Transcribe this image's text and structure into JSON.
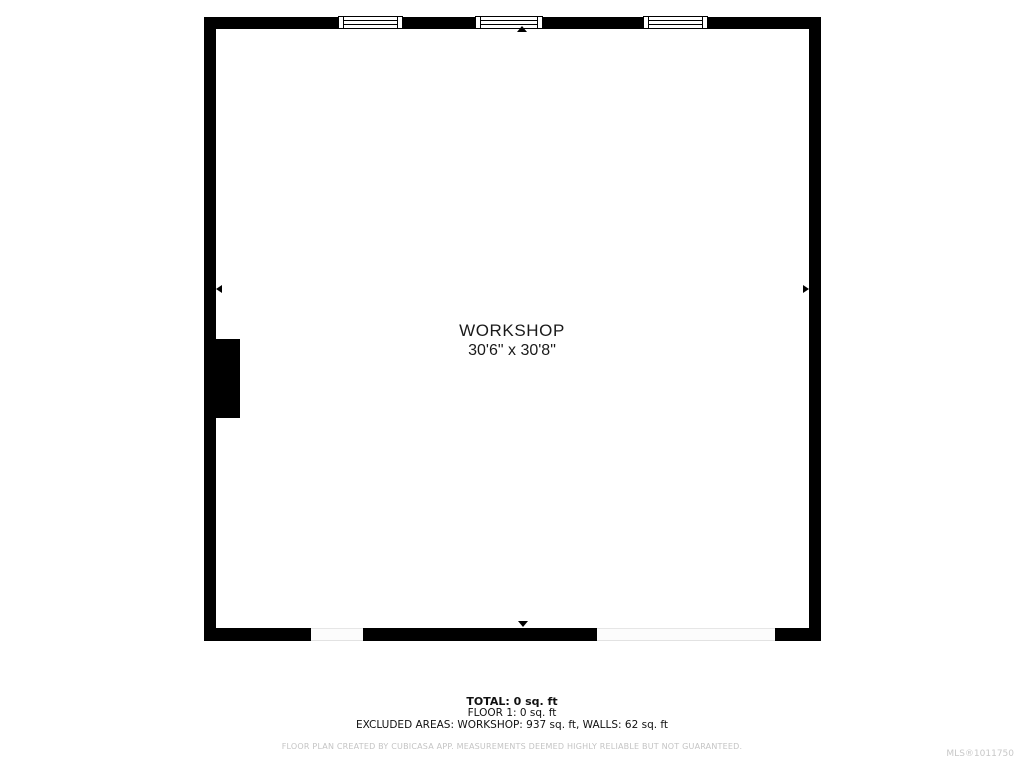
{
  "colors": {
    "wall": "#000000",
    "background": "#ffffff",
    "label_text": "#1a1a1a",
    "muted_text": "#c4c4c4"
  },
  "plan": {
    "room_label": "WORKSHOP",
    "room_dimensions": "30'6\" x 30'8\"",
    "windows_count": 3,
    "door_openings_count": 2
  },
  "summary": {
    "total": "TOTAL: 0 sq. ft",
    "floor": "FLOOR 1: 0 sq. ft",
    "excluded": "EXCLUDED AREAS: WORKSHOP: 937 sq. ft, WALLS: 62 sq. ft"
  },
  "footer": {
    "disclaimer": "FLOOR PLAN CREATED BY CUBICASA APP. MEASUREMENTS DEEMED HIGHLY RELIABLE BUT NOT GUARANTEED.",
    "mls_number": "MLS®1011750"
  }
}
